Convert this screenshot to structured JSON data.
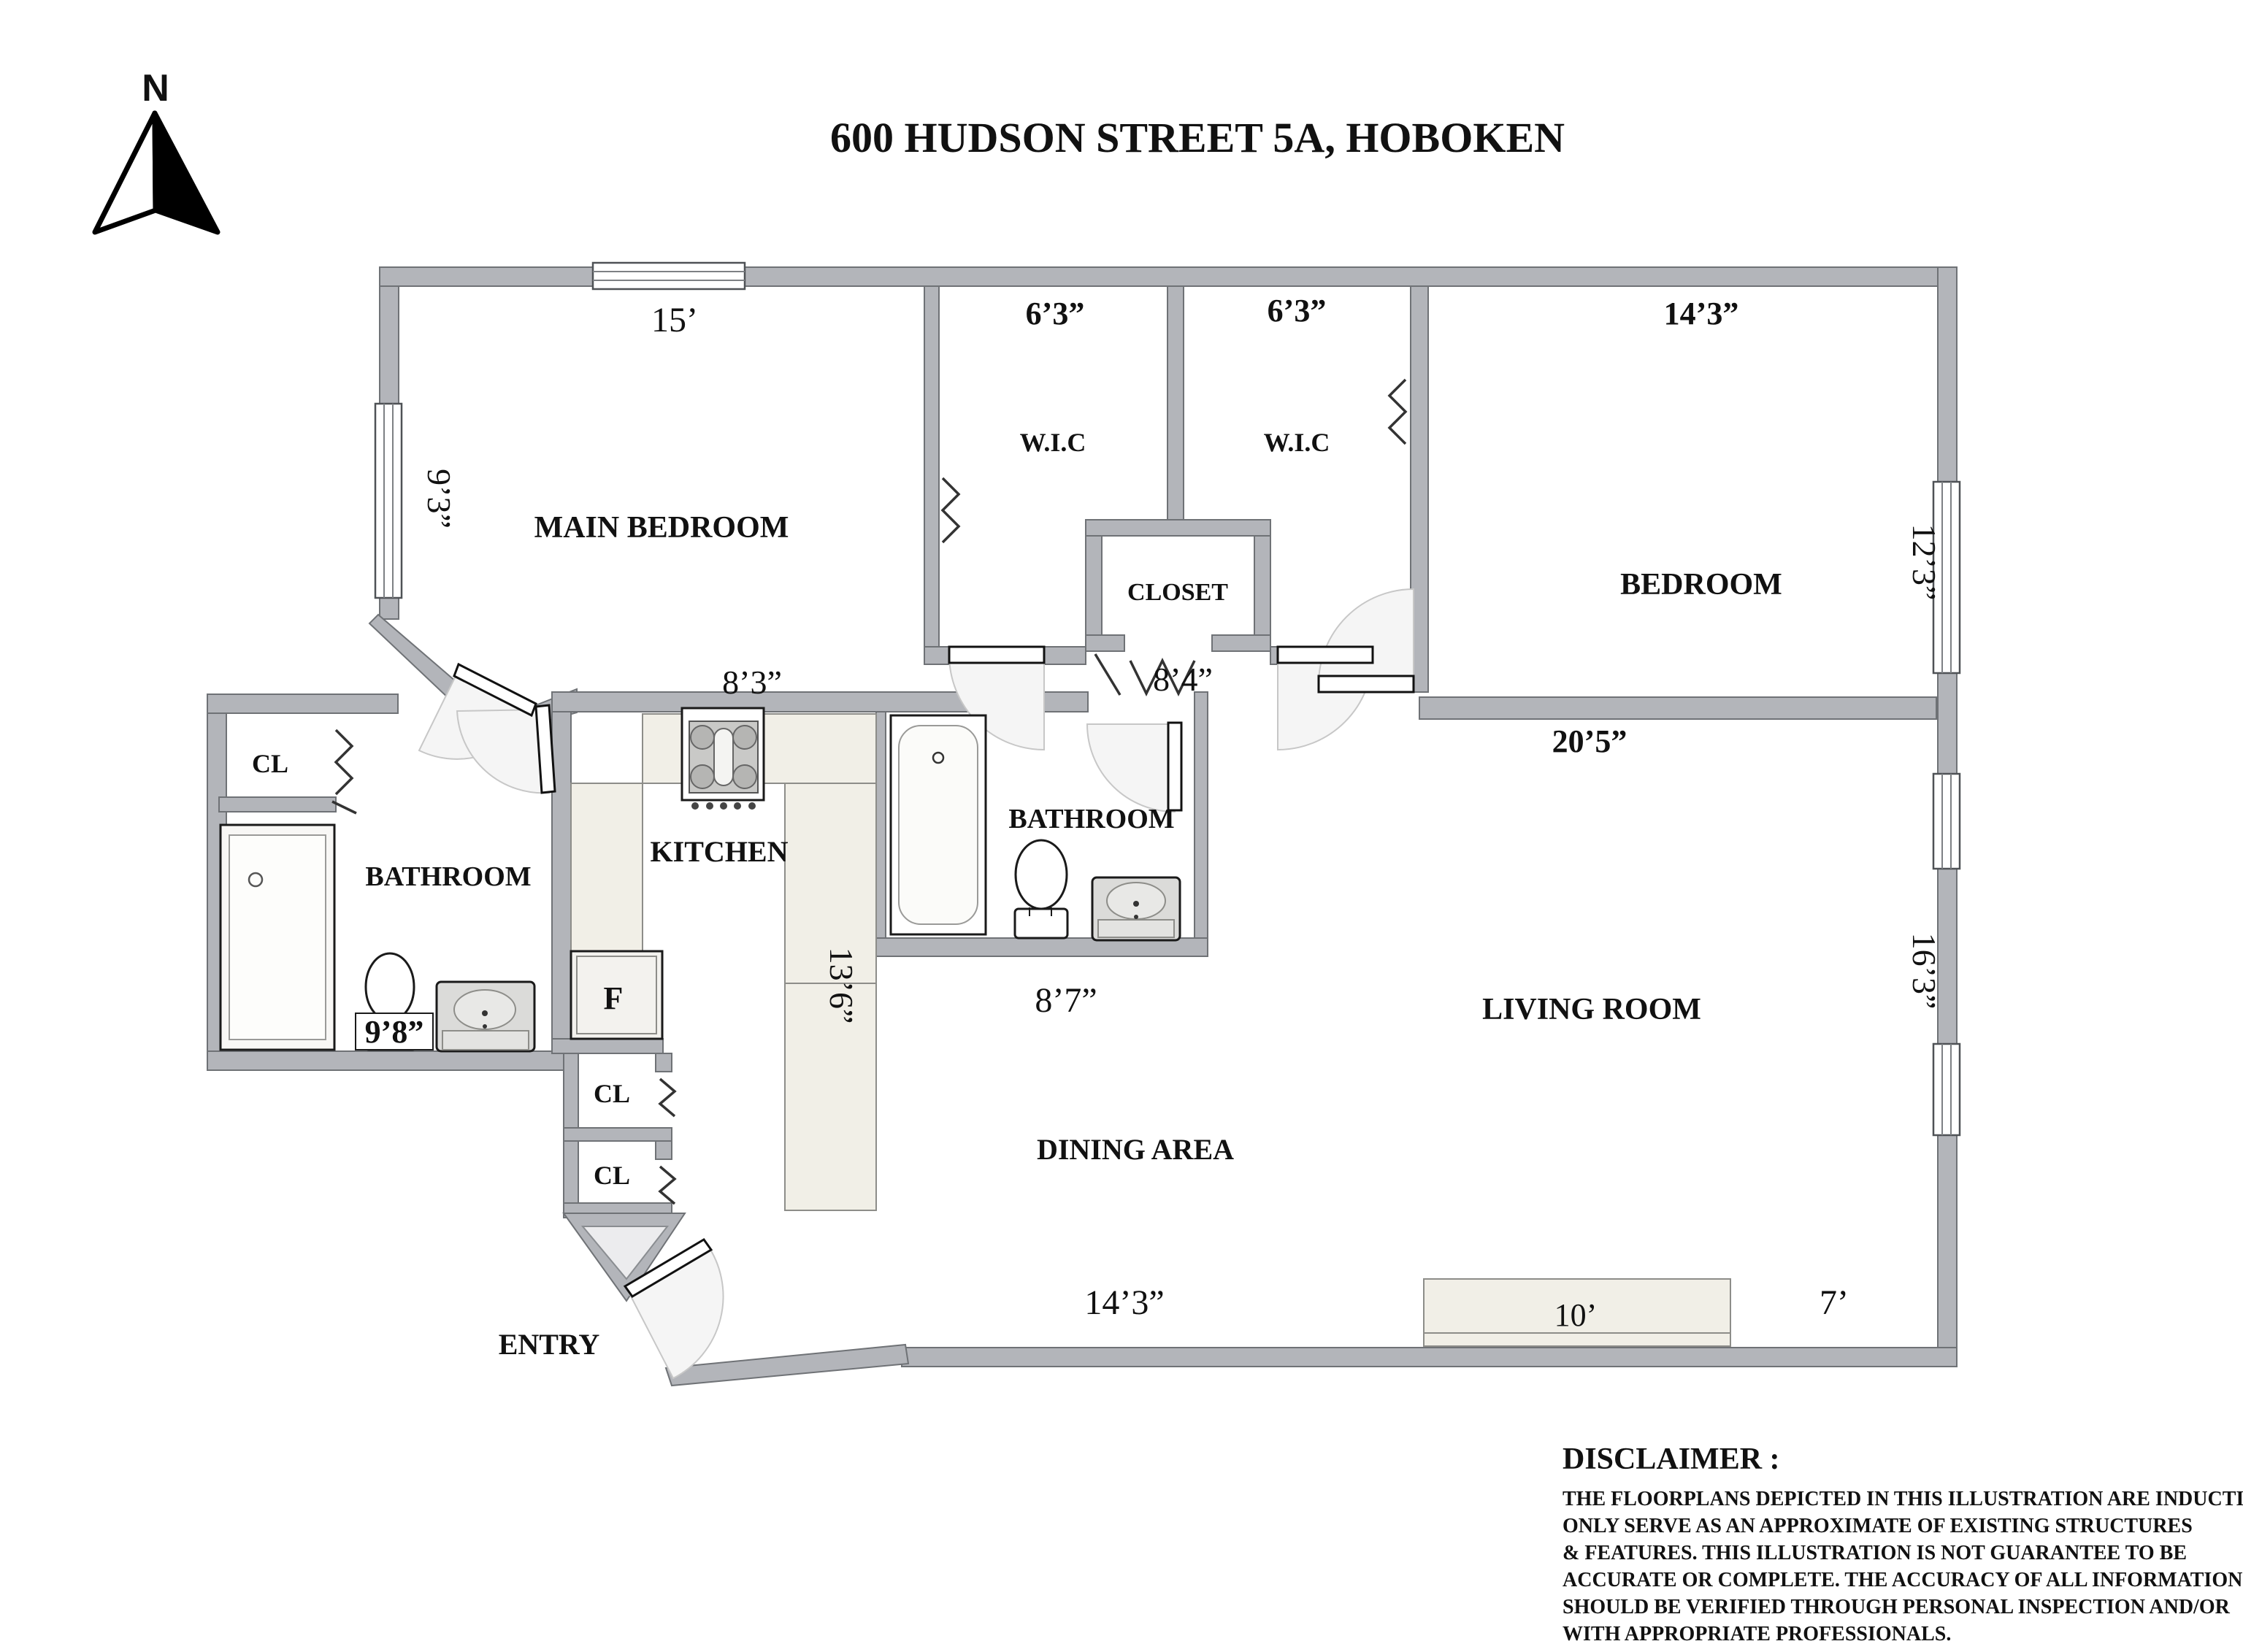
{
  "title": "600 HUDSON STREET 5A, HOBOKEN",
  "compass": {
    "label": "N"
  },
  "rooms": {
    "main_bedroom": "MAIN BEDROOM",
    "wic_left": "W.I.C",
    "wic_right": "W.I.C",
    "closet": "CLOSET",
    "bedroom": "BEDROOM",
    "bathroom_left": "BATHROOM",
    "bathroom_mid": "BATHROOM",
    "kitchen": "KITCHEN",
    "living_room": "LIVING ROOM",
    "dining_area": "DINING AREA",
    "entry": "ENTRY",
    "cl_bath": "CL",
    "cl_1": "CL",
    "cl_2": "CL",
    "fridge": "F"
  },
  "dims": {
    "main_bedroom_w": "15’",
    "main_bedroom_h": "9’3”",
    "wic_left_w": "6’3”",
    "wic_right_w": "6’3”",
    "bedroom_w": "14’3”",
    "bedroom_h": "12’3”",
    "hall_w": "8’4”",
    "kitchen_w": "8’3”",
    "living_top_w": "20’5”",
    "bath_left_w": "9’8”",
    "kitchen_h": "13’6”",
    "bath_mid_w": "8’7”",
    "living_h": "16’3”",
    "dining_w": "14’3”",
    "console_w": "10’",
    "living_bottom_r": "7’"
  },
  "disclaimer": {
    "heading": "DISCLAIMER :",
    "lines": [
      "THE FLOORPLANS DEPICTED IN THIS ILLUSTRATION ARE INDUCTIVE",
      "ONLY SERVE AS AN APPROXIMATE OF EXISTING STRUCTURES",
      "& FEATURES. THIS ILLUSTRATION IS NOT GUARANTEE TO BE",
      "ACCURATE OR COMPLETE. THE ACCURACY OF ALL INFORMATION",
      "SHOULD BE VERIFIED THROUGH PERSONAL  INSPECTION AND/OR",
      "WITH APPROPRIATE PROFESSIONALS."
    ]
  },
  "colors": {
    "wall": "#b3b5ba",
    "wall_stroke": "#6f7276",
    "counter": "#f1efe7",
    "counter_stroke": "#8d8d89",
    "fixture_fill": "#ffffff",
    "fixture_stroke": "#1a1a1a",
    "arc_fill": "#f5f5f5",
    "arc_stroke": "#c7c7c7",
    "vanity": "#dbdbd9",
    "light_triangle": "#ececee",
    "text": "#111111"
  }
}
